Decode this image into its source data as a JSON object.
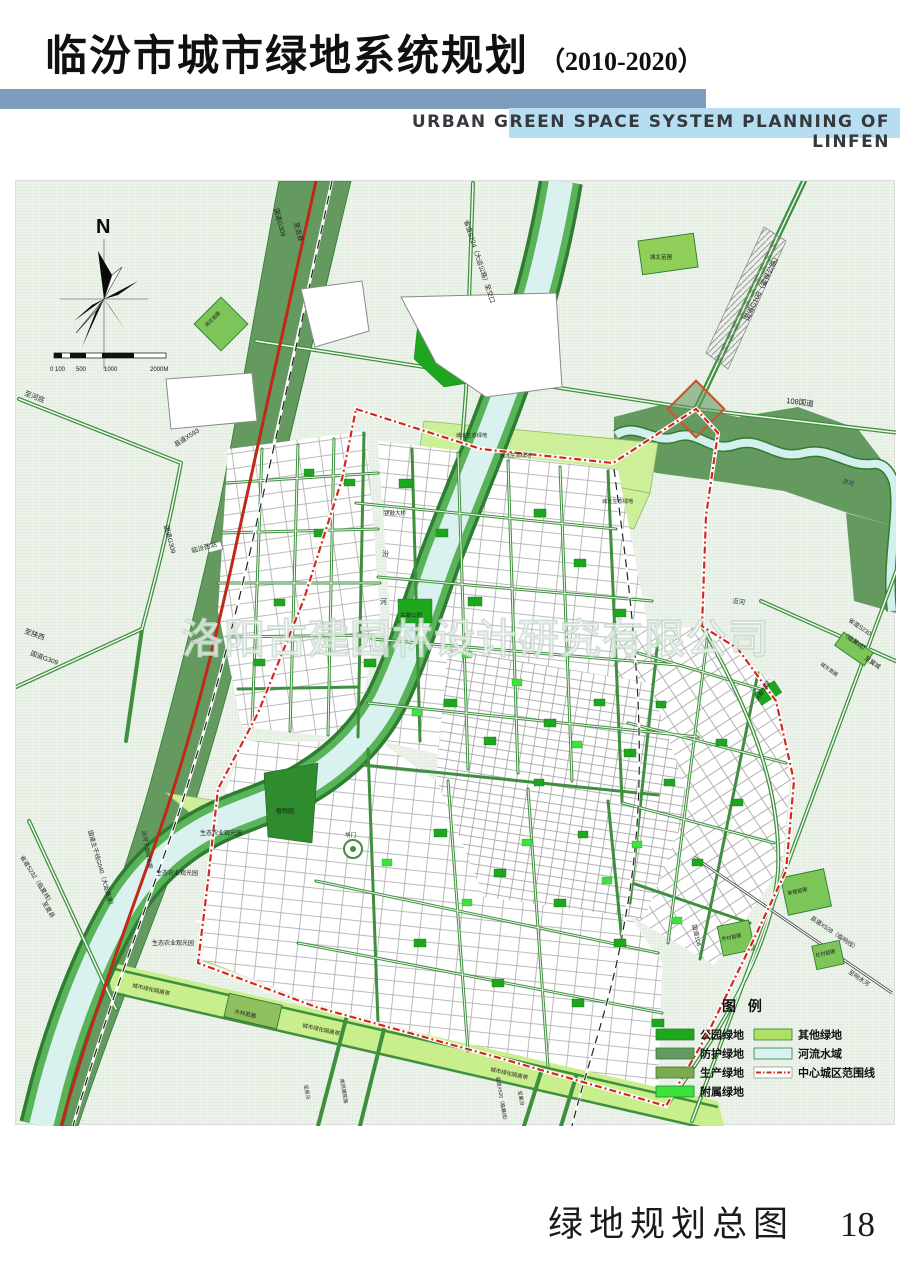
{
  "header": {
    "title_zh": "临汾市城市绿地系统规划",
    "title_year": "（2010-2020）",
    "title_en": "URBAN GREEN SPACE SYSTEM PLANNING OF LINFEN"
  },
  "footer": {
    "caption": "绿地规划总图",
    "page_number": "18"
  },
  "colors": {
    "header_bar_dark": "#7e9cbd",
    "header_bar_light": "#b6def0",
    "map_background": "#eef4ec",
    "boundary_red": "#d4281c",
    "highway_red": "#c22817"
  },
  "map": {
    "compass_label": "N",
    "scale_labels": [
      "0 100",
      "500",
      "1000",
      "2000M"
    ],
    "watermark": "洛阳古建园林设计研究有限公司",
    "legend": {
      "title": "图  例",
      "items": [
        {
          "label": "公园绿地",
          "color": "#1fa61f"
        },
        {
          "label": "防护绿地",
          "color": "#649a60"
        },
        {
          "label": "生产绿地",
          "color": "#7ea94c"
        },
        {
          "label": "附属绿地",
          "color": "#3ae43a"
        },
        {
          "label": "其他绿地",
          "color": "#aee063"
        },
        {
          "label": "河流水域",
          "color": "#d8f3f3"
        },
        {
          "label": "中心城区范围线",
          "color": "#ffffff",
          "boundary": true
        }
      ]
    },
    "labels": [
      {
        "t": "至河底",
        "x": 8,
        "y": 214,
        "r": 22,
        "s": 7
      },
      {
        "t": "县道X593",
        "x": 160,
        "y": 266,
        "r": -33,
        "s": 6.5
      },
      {
        "t": "国道G309",
        "x": 148,
        "y": 345,
        "r": 75,
        "s": 6.5
      },
      {
        "t": "至陕西",
        "x": 8,
        "y": 452,
        "r": 20,
        "s": 7
      },
      {
        "t": "国道G309",
        "x": 14,
        "y": 474,
        "r": 20,
        "s": 6.5
      },
      {
        "t": "国道G309",
        "x": 258,
        "y": 28,
        "r": 75,
        "s": 6.5
      },
      {
        "t": "至吉县",
        "x": 278,
        "y": 42,
        "r": 75,
        "s": 6.5
      },
      {
        "t": "省道S224（大运公路）至交口",
        "x": 448,
        "y": 40,
        "r": 72,
        "s": 6.5
      },
      {
        "t": "城北苗圃",
        "x": 634,
        "y": 78,
        "r": 0,
        "s": 5.5
      },
      {
        "t": "国道G108（霍侯公路）",
        "x": 732,
        "y": 140,
        "r": -64,
        "s": 7
      },
      {
        "t": "108国道",
        "x": 770,
        "y": 222,
        "r": 7,
        "s": 7.5
      },
      {
        "t": "南庄苗圃",
        "x": 191,
        "y": 146,
        "r": -45,
        "s": 4.8
      },
      {
        "t": "临汾西站",
        "x": 176,
        "y": 372,
        "r": -15,
        "s": 6.5,
        "c": "#113311"
      },
      {
        "t": "城北生态绿地",
        "x": 440,
        "y": 256,
        "r": 0,
        "s": 5.2
      },
      {
        "t": "城北生态绿地",
        "x": 484,
        "y": 276,
        "r": 0,
        "s": 5.2
      },
      {
        "t": "城北生态绿地",
        "x": 586,
        "y": 322,
        "r": 0,
        "s": 5.2
      },
      {
        "t": "济河",
        "x": 826,
        "y": 302,
        "r": 15,
        "s": 6,
        "c": "#223344"
      },
      {
        "t": "洰河",
        "x": 716,
        "y": 422,
        "r": 8,
        "s": 6.5,
        "c": "#223344"
      },
      {
        "t": "汾",
        "x": 366,
        "y": 375,
        "r": 0,
        "s": 7,
        "c": "#223344"
      },
      {
        "t": "河",
        "x": 364,
        "y": 423,
        "r": 0,
        "s": 7,
        "c": "#223344"
      },
      {
        "t": "省道S230",
        "x": 832,
        "y": 440,
        "r": 35,
        "s": 6
      },
      {
        "t": "（临翼线）",
        "x": 826,
        "y": 454,
        "r": 35,
        "s": 6
      },
      {
        "t": "至翼城",
        "x": 848,
        "y": 478,
        "r": 35,
        "s": 6
      },
      {
        "t": "城东苗圃",
        "x": 804,
        "y": 484,
        "r": 35,
        "s": 5
      },
      {
        "t": "锣鼓大桥",
        "x": 368,
        "y": 334,
        "r": 0,
        "s": 5.5
      },
      {
        "t": "古城公园",
        "x": 384,
        "y": 436,
        "r": 0,
        "s": 5.5
      },
      {
        "t": "植物园",
        "x": 260,
        "y": 632,
        "r": 0,
        "s": 6
      },
      {
        "t": "华门",
        "x": 329,
        "y": 656,
        "r": 0,
        "s": 5.5
      },
      {
        "t": "生态农业观光园",
        "x": 184,
        "y": 654,
        "r": 0,
        "s": 6
      },
      {
        "t": "生态农业观光园",
        "x": 140,
        "y": 694,
        "r": 0,
        "s": 6
      },
      {
        "t": "生态农业观光园",
        "x": 136,
        "y": 764,
        "r": 0,
        "s": 6
      },
      {
        "t": "尧都公园",
        "x": 742,
        "y": 520,
        "r": -56,
        "s": 5.5
      },
      {
        "t": "国道108",
        "x": 676,
        "y": 744,
        "r": 76,
        "s": 6
      },
      {
        "t": "县道X528（临响线）",
        "x": 794,
        "y": 738,
        "r": 34,
        "s": 6
      },
      {
        "t": "至响水河",
        "x": 832,
        "y": 792,
        "r": 34,
        "s": 6
      },
      {
        "t": "新建苗圃",
        "x": 772,
        "y": 714,
        "r": -12,
        "s": 5
      },
      {
        "t": "乔村苗圃",
        "x": 706,
        "y": 760,
        "r": -12,
        "s": 5
      },
      {
        "t": "杜村苗圃",
        "x": 800,
        "y": 776,
        "r": -12,
        "s": 5
      },
      {
        "t": "大林苗圃",
        "x": 218,
        "y": 832,
        "r": 13,
        "s": 5.5
      },
      {
        "t": "城市绿化隔离带",
        "x": 116,
        "y": 806,
        "r": 13,
        "s": 5.5
      },
      {
        "t": "城市绿化隔离带",
        "x": 286,
        "y": 846,
        "r": 13,
        "s": 5.5
      },
      {
        "t": "城市绿化隔离带",
        "x": 474,
        "y": 890,
        "r": 13,
        "s": 5.5
      },
      {
        "t": "至侯马",
        "x": 288,
        "y": 904,
        "r": 80,
        "s": 5
      },
      {
        "t": "南同蒲铁路",
        "x": 324,
        "y": 898,
        "r": 80,
        "s": 5
      },
      {
        "t": "县道X520（临襄线）",
        "x": 480,
        "y": 896,
        "r": 80,
        "s": 5
      },
      {
        "t": "至襄汾",
        "x": 502,
        "y": 910,
        "r": 80,
        "s": 5
      },
      {
        "t": "省道S232（临夏线）",
        "x": 4,
        "y": 676,
        "r": 58,
        "s": 6
      },
      {
        "t": "至夏县",
        "x": 26,
        "y": 722,
        "r": 58,
        "s": 6
      },
      {
        "t": "国道主干线G040（大运高速）",
        "x": 72,
        "y": 650,
        "r": 74,
        "s": 6
      },
      {
        "t": "汾河下游绿化带",
        "x": 126,
        "y": 650,
        "r": 80,
        "s": 5.5
      }
    ]
  }
}
